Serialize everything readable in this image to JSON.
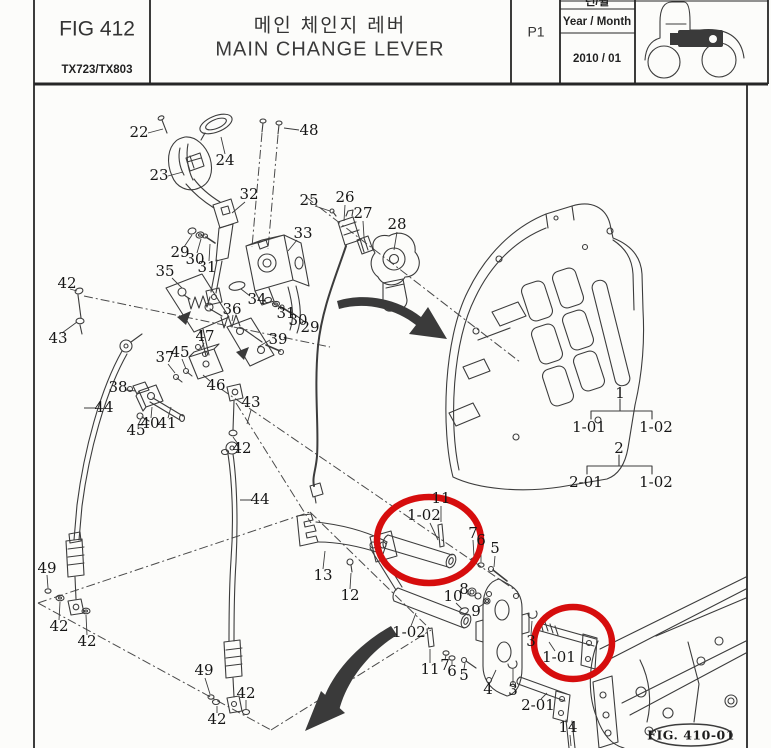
{
  "header": {
    "figure_number": "FIG 412",
    "model": "TX723/TX803",
    "title_korean": "메인 체인지 레버",
    "title_english": "MAIN CHANGE LEVER",
    "page": "P1",
    "year_month_korean": "년/월",
    "year_month_label": "Year / Month",
    "year_month_value": "2010 / 01",
    "tractor_icon": "tractor-side-view-icon"
  },
  "diagram": {
    "figure_reference": "FIG. 410-01",
    "highlight_color": "#d60d0d",
    "line_color": "#3c3c3c",
    "highlighted_parts": [
      "1-02",
      "1-01"
    ],
    "assembly_tree": [
      {
        "parent": "1",
        "children": [
          "1-01",
          "1-02"
        ]
      },
      {
        "parent": "2",
        "children": [
          "2-01",
          "1-02"
        ]
      }
    ],
    "part_labels": [
      {
        "text": "22",
        "x": 139,
        "y": 133
      },
      {
        "text": "23",
        "x": 159,
        "y": 176
      },
      {
        "text": "24",
        "x": 225,
        "y": 161
      },
      {
        "text": "48",
        "x": 309,
        "y": 131
      },
      {
        "text": "32",
        "x": 249,
        "y": 195
      },
      {
        "text": "25",
        "x": 309,
        "y": 201
      },
      {
        "text": "26",
        "x": 345,
        "y": 198
      },
      {
        "text": "27",
        "x": 363,
        "y": 214
      },
      {
        "text": "28",
        "x": 397,
        "y": 225
      },
      {
        "text": "29",
        "x": 180,
        "y": 253
      },
      {
        "text": "30",
        "x": 195,
        "y": 260
      },
      {
        "text": "31",
        "x": 207,
        "y": 268
      },
      {
        "text": "33",
        "x": 303,
        "y": 234
      },
      {
        "text": "34",
        "x": 257,
        "y": 300
      },
      {
        "text": "35",
        "x": 165,
        "y": 272
      },
      {
        "text": "36",
        "x": 232,
        "y": 310
      },
      {
        "text": "31",
        "x": 286,
        "y": 314
      },
      {
        "text": "30",
        "x": 298,
        "y": 321
      },
      {
        "text": "29",
        "x": 310,
        "y": 328
      },
      {
        "text": "39",
        "x": 278,
        "y": 340
      },
      {
        "text": "47",
        "x": 205,
        "y": 337
      },
      {
        "text": "37",
        "x": 165,
        "y": 358
      },
      {
        "text": "45",
        "x": 180,
        "y": 353
      },
      {
        "text": "38",
        "x": 118,
        "y": 388
      },
      {
        "text": "46",
        "x": 216,
        "y": 386
      },
      {
        "text": "40",
        "x": 150,
        "y": 424
      },
      {
        "text": "41",
        "x": 167,
        "y": 424
      },
      {
        "text": "45",
        "x": 136,
        "y": 431
      },
      {
        "text": "42",
        "x": 67,
        "y": 284
      },
      {
        "text": "43",
        "x": 58,
        "y": 339
      },
      {
        "text": "44",
        "x": 104,
        "y": 408
      },
      {
        "text": "43",
        "x": 251,
        "y": 403
      },
      {
        "text": "42",
        "x": 242,
        "y": 449
      },
      {
        "text": "44",
        "x": 260,
        "y": 500
      },
      {
        "text": "49",
        "x": 47,
        "y": 569
      },
      {
        "text": "42",
        "x": 59,
        "y": 627
      },
      {
        "text": "42",
        "x": 87,
        "y": 642
      },
      {
        "text": "49",
        "x": 204,
        "y": 671
      },
      {
        "text": "42",
        "x": 217,
        "y": 720
      },
      {
        "text": "42",
        "x": 246,
        "y": 694
      },
      {
        "text": "13",
        "x": 323,
        "y": 576
      },
      {
        "text": "12",
        "x": 350,
        "y": 596
      },
      {
        "text": "11",
        "x": 441,
        "y": 499
      },
      {
        "text": "1-02",
        "x": 424,
        "y": 516
      },
      {
        "text": "7",
        "x": 473,
        "y": 534
      },
      {
        "text": "6",
        "x": 481,
        "y": 541
      },
      {
        "text": "5",
        "x": 495,
        "y": 549
      },
      {
        "text": "10",
        "x": 453,
        "y": 597
      },
      {
        "text": "8",
        "x": 464,
        "y": 590
      },
      {
        "text": "9",
        "x": 476,
        "y": 612
      },
      {
        "text": "1-02",
        "x": 409,
        "y": 633
      },
      {
        "text": "11",
        "x": 430,
        "y": 670
      },
      {
        "text": "7",
        "x": 445,
        "y": 666
      },
      {
        "text": "6",
        "x": 452,
        "y": 672
      },
      {
        "text": "5",
        "x": 464,
        "y": 676
      },
      {
        "text": "4",
        "x": 488,
        "y": 690
      },
      {
        "text": "3",
        "x": 531,
        "y": 642
      },
      {
        "text": "3",
        "x": 513,
        "y": 691
      },
      {
        "text": "1-01",
        "x": 559,
        "y": 658
      },
      {
        "text": "2-01",
        "x": 538,
        "y": 706
      },
      {
        "text": "14",
        "x": 568,
        "y": 728
      }
    ]
  }
}
